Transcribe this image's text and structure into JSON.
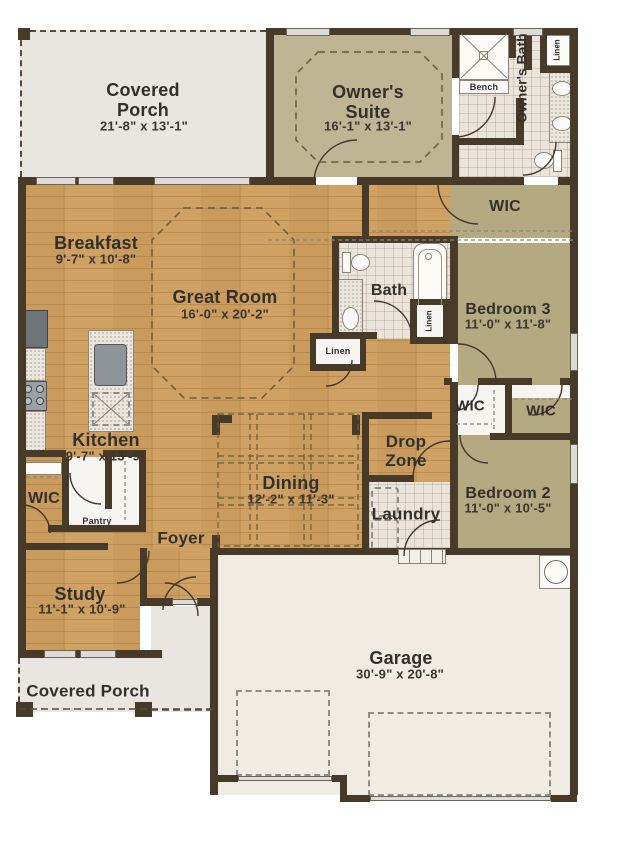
{
  "rooms": {
    "covered_porch_top": {
      "name": "Covered Porch",
      "dims": "21'-8\" x 13'-1\""
    },
    "owners_suite": {
      "name": "Owner's Suite",
      "dims": "16'-1\" x 13'-1\""
    },
    "owners_bath": {
      "name": "Owner's Bath"
    },
    "owners_wic": {
      "name": "WIC"
    },
    "breakfast": {
      "name": "Breakfast",
      "dims": "9'-7\" x 10'-8\""
    },
    "great_room": {
      "name": "Great Room",
      "dims": "16'-0\" x 20'-2\""
    },
    "bath": {
      "name": "Bath"
    },
    "bedroom_3": {
      "name": "Bedroom 3",
      "dims": "11'-0\" x 11'-8\""
    },
    "wic_bedroom_3": {
      "name": "WIC"
    },
    "wic_bedroom_2": {
      "name": "WIC"
    },
    "bedroom_2": {
      "name": "Bedroom 2",
      "dims": "11'-0\" x 10'-5\""
    },
    "kitchen": {
      "name": "Kitchen",
      "dims": "9'-7\" x 13'-9\""
    },
    "kitchen_wic": {
      "name": "WIC"
    },
    "pantry": {
      "name": "Pantry"
    },
    "foyer": {
      "name": "Foyer"
    },
    "dining": {
      "name": "Dining",
      "dims": "12'-2\" x 11'-3\""
    },
    "drop_zone": {
      "name": "Drop Zone"
    },
    "laundry": {
      "name": "Laundry"
    },
    "study": {
      "name": "Study",
      "dims": "11'-1\" x 10'-9\""
    },
    "covered_porch_bottom": {
      "name": "Covered Porch"
    },
    "garage": {
      "name": "Garage",
      "dims": "30'-9\" x 20'-8\""
    }
  },
  "closets": {
    "linen_owners_bath": "Linen",
    "linen_hall": "Linen",
    "linen_bedroom_hall": "Linen",
    "shower_bench": "Bench"
  },
  "colors": {
    "wall": "#473a29",
    "wood_floor": "#cfa263",
    "tile_floor": "#eae4da",
    "bedroom_floor": "#b4a981",
    "suite_floor": "#bfb494",
    "porch_floor": "#e9e6e1",
    "garage_floor": "#f0ece4"
  }
}
